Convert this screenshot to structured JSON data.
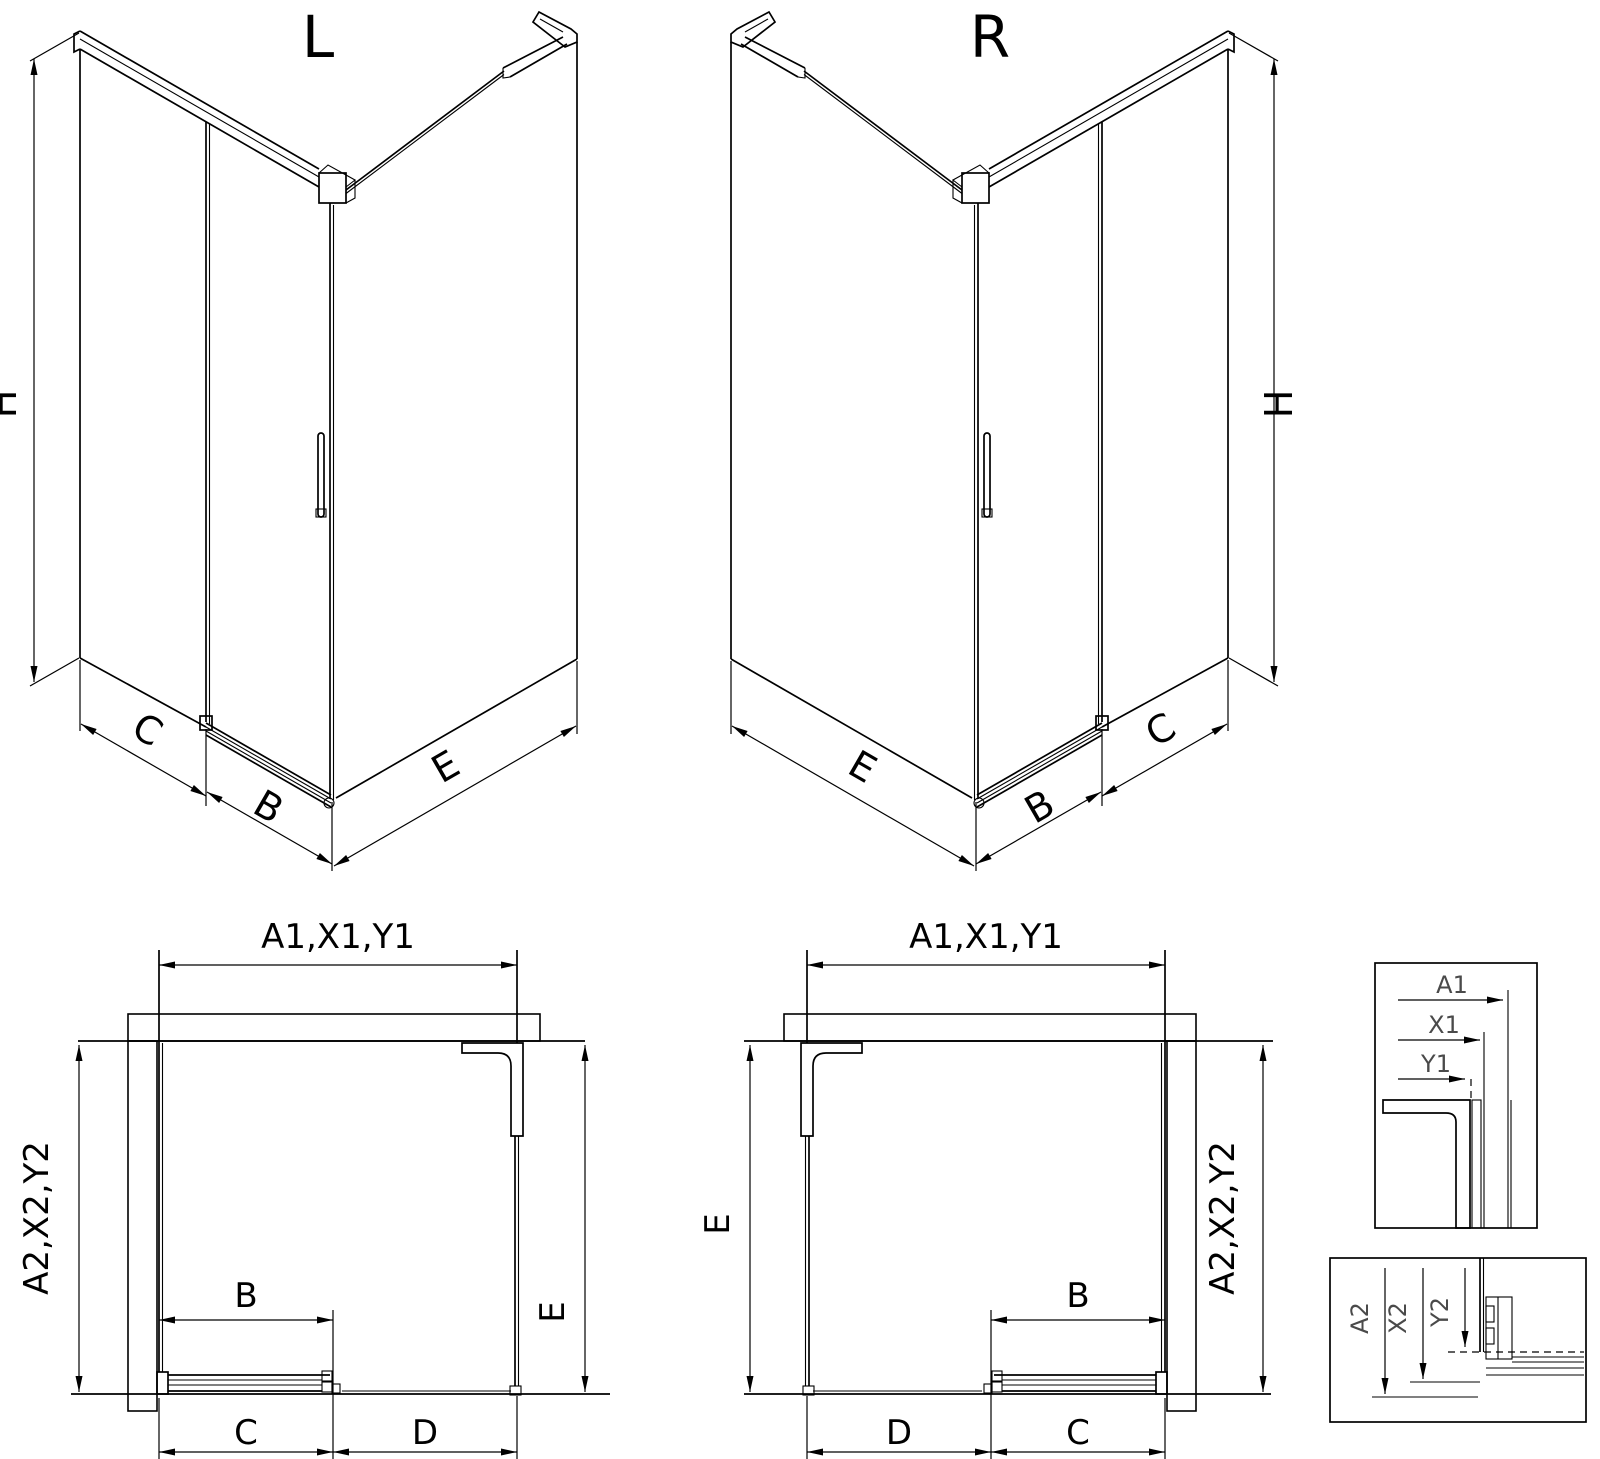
{
  "drawing": {
    "iso_left": {
      "title": "L",
      "height_label": "H",
      "side_label": "C",
      "door_label": "B",
      "panel_label": "E"
    },
    "iso_right": {
      "title": "R",
      "height_label": "H",
      "side_label": "C",
      "door_label": "B",
      "panel_label": "E"
    },
    "plan_left": {
      "width_label": "A1,X1,Y1",
      "depth_label": "A2,X2,Y2",
      "panel_label": "E",
      "door_label": "B",
      "fixed_label": "C",
      "opening_label": "D"
    },
    "plan_right": {
      "width_label": "A1,X1,Y1",
      "depth_label": "A2,X2,Y2",
      "panel_label": "E",
      "door_label": "B",
      "fixed_label": "C",
      "opening_label": "D"
    },
    "detail_top": {
      "a1": "A1",
      "x1": "X1",
      "y1": "Y1"
    },
    "detail_bottom": {
      "a2": "A2",
      "x2": "X2",
      "y2": "Y2"
    }
  },
  "colors": {
    "line": "#000000",
    "background": "#ffffff",
    "detail_label": "#4a4a4a"
  }
}
